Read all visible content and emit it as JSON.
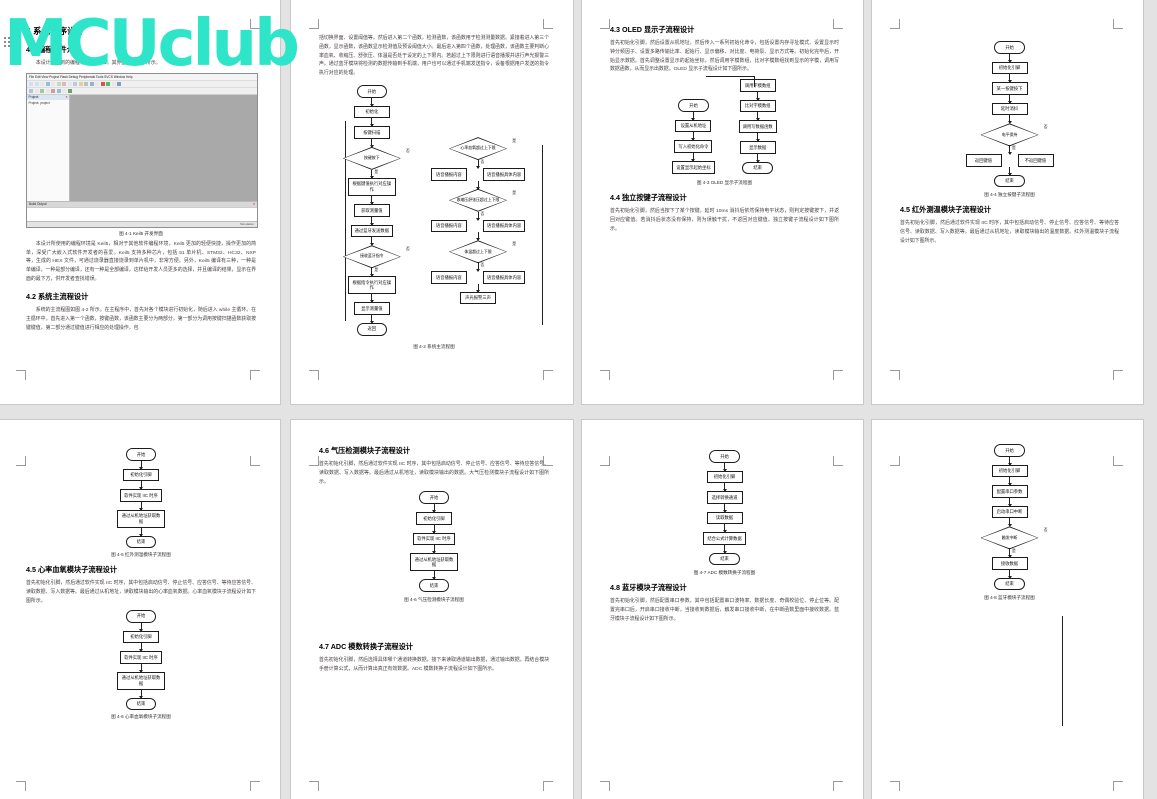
{
  "watermark": {
    "text": "MCUclub",
    "color": "#2ee5ca"
  },
  "page1": {
    "h1": "4 系统程序设计",
    "h2": "4.1 编程软件介绍",
    "intro": "本设计所用到的编程软件为 Keil5，其界面如图 4-1 所示。",
    "keil": {
      "menu": "File Edit View Project Flash Debug Peripherals Tools SVCS Window Help",
      "panel_title": "Project",
      "tree_item": "Project: project",
      "output_title": "Build Output",
      "status": "Simulation"
    },
    "caption": "图 4-1 Keil5 开发界面",
    "para": "本设计所使用的编程环境是 Keil5，相对于其他软件编程环境，Keil5 更加的轻便快捷，操作更加的简单，深受广大嵌入式软件开发者的喜爱。Keil5 支持多种芯片，包括 51 单片机、STM32、HC32、NXP 等，生成的 HEX 文件，可通过烧录器直接烧录到单片机中，非常方便。另外，Keil5 编译有三种，一种是单编译，一种是部分编译，还有一种是全部编译，这样给开发人员更多的选择，并且编译的结果，显示在界面的最下方，供开发者查找错误。",
    "h3": "4.2 系统主流程设计",
    "para2": "系统的主流程图如图 4-2 所示。在主程序中，首先对各个模块进行初始化，随后进入 while 主循环。在主循环中，首先进入第一个函数，按键函数，该函数主要分为两部分，第一部分为调用按键扫描函数获取按键键值，第二部分通过键值进行相应的处理操作，包"
  },
  "page2": {
    "para": "括切换界面、设置阈值等。然后进入第二个函数，检测函数，该函数用于检测测量数据。紧接着进入第三个函数，显示函数，该函数显示检测值及预设阈值大小。最后进入第四个函数，处理函数，该函数主要判断心率血氧、收缩压、舒张压、体温是否处于设定的上下限内。若超过上下限则进行语音播报并进行声光报警三声。通过蓝牙模块将检测的数据传输到手机端，用户也可以通过手机端发送指令，设备根据用户发送的指令执行对应的处理。",
    "caption": "图 4-2 系统主流程图",
    "fcL": [
      {
        "k": "t",
        "t": "开始"
      },
      {
        "k": "b",
        "t": "初始化"
      },
      {
        "k": "b",
        "t": "按键扫描"
      },
      {
        "k": "d",
        "t": "按键按下",
        "rl": "否"
      },
      {
        "k": "b",
        "t": "根据键值执行对应操作",
        "al": "是"
      },
      {
        "k": "b",
        "t": "获取测量值"
      },
      {
        "k": "b",
        "t": "通过蓝牙发送数据"
      },
      {
        "k": "d",
        "t": "接收蓝牙指令",
        "rl": "否"
      },
      {
        "k": "b",
        "t": "根据指令执行对应操作",
        "al": "是"
      },
      {
        "k": "b",
        "t": "显示测量值"
      },
      {
        "k": "t",
        "t": "返回"
      }
    ],
    "fcR": [
      {
        "k": "d",
        "t": "心率血氧超过上下限",
        "rl": "是"
      },
      {
        "k": "row",
        "al": "否",
        "items": [
          {
            "t": "语音播报内容"
          },
          {
            "t": "语音播报具体内容"
          }
        ]
      },
      {
        "k": "d",
        "t": "收缩压舒张压超过上下限",
        "rl": "是"
      },
      {
        "k": "row",
        "al": "否",
        "items": [
          {
            "t": "语音播报内容"
          },
          {
            "t": "语音播报具体内容"
          }
        ]
      },
      {
        "k": "d",
        "t": "体温超过上下限",
        "rl": "是"
      },
      {
        "k": "row",
        "al": "否",
        "items": [
          {
            "t": "语音播报内容"
          },
          {
            "t": "语音播报具体内容"
          }
        ]
      },
      {
        "k": "b",
        "t": "声光报警三声"
      }
    ]
  },
  "page3": {
    "h1": "4.3 OLED 显示子流程设计",
    "para": "首先初始化引脚，然后设置从机地址，然后传入一系列初始化命令，包括设置内存寻址模式、设置显示时钟分频因子、设置多路传输比率、起始行、显示偏移、对比度、电荷泵、显示方式等。初始化完毕后，开始显示数据。首先调整设置显示的起始坐标，然后调用字模数组，比对字模数组找到显示的字模，调用写数据函数，从而显示出数据。OLED 显示子流程设计如下图所示。",
    "fcL": [
      {
        "k": "t",
        "t": "开始"
      },
      {
        "k": "b",
        "t": "设置从机地址"
      },
      {
        "k": "b",
        "t": "写入初始化命令"
      },
      {
        "k": "b",
        "t": "设置显示起始坐标"
      }
    ],
    "fcR": [
      {
        "k": "b",
        "t": "调用字模数组"
      },
      {
        "k": "b",
        "t": "比对字模数组"
      },
      {
        "k": "b",
        "t": "调用写数据函数"
      },
      {
        "k": "b",
        "t": "显示数据"
      },
      {
        "k": "t",
        "t": "结束"
      }
    ],
    "caption": "图 4-3 OLED 显示子流程图",
    "h2": "4.4 独立按键子流程设计",
    "para2": "首先初始化引脚，然后当按下了某个按键，延时 10ms 消抖后依然保持电平状态，则判定按键按下，并返回对应键值。若消抖后状态没有保持，则为误触干扰，不返回对应键值。独立按键子流程设计如下图所示。"
  },
  "page4": {
    "fc": [
      {
        "k": "t",
        "t": "开始"
      },
      {
        "k": "b",
        "t": "初始化引脚"
      },
      {
        "k": "b",
        "t": "某一按键按下"
      },
      {
        "k": "b",
        "t": "延时消抖"
      },
      {
        "k": "d",
        "t": "电平保持",
        "rl": "否"
      },
      {
        "k": "row",
        "al": "是",
        "items": [
          {
            "t": "返回键值"
          },
          {
            "t": "不返回键值"
          }
        ]
      },
      {
        "k": "t",
        "t": "结束"
      }
    ],
    "caption": "图 4-4 独立按键子流程图",
    "h1": "4.5 红外测温模块子流程设计",
    "para": "首先初始化引脚，然后通过软件实现 IIC 时序，其中包括启动信号、停止信号、应答信号、等待应答信号、读取数据、写入数据等。最后通过从机地址，读取模块输出的温度数据。红外测温模块子流程设计如下图所示。"
  },
  "page5": {
    "fc1": [
      {
        "k": "t",
        "t": "开始"
      },
      {
        "k": "b",
        "t": "初始化引脚"
      },
      {
        "k": "b",
        "t": "软件实现 IIC 时序"
      },
      {
        "k": "b",
        "t": "通过从机地址获取数据"
      },
      {
        "k": "t",
        "t": "结束"
      }
    ],
    "caption1": "图 4-5 红外测温模块子流程图",
    "h1": "4.5 心率血氧模块子流程设计",
    "para": "首先初始化引脚，然后通过软件实现 IIC 时序，其中包括启动信号、停止信号、应答信号、等待应答信号、读取数据、写入数据等。最后通过从机地址，读取模块输出的心率血氧数据。心率血氧模块子流程设计如下图所示。",
    "fc2": [
      {
        "k": "t",
        "t": "开始"
      },
      {
        "k": "b",
        "t": "初始化引脚"
      },
      {
        "k": "b",
        "t": "软件实现 IIC 时序"
      },
      {
        "k": "b",
        "t": "通过从机地址获取数据"
      },
      {
        "k": "t",
        "t": "结束"
      }
    ],
    "caption2": "图 4-6 心率血氧模块子流程图"
  },
  "page6": {
    "h1": "4.6 气压检测模块子流程设计",
    "para": "首先初始化引脚，然后通过软件实现 IIC 时序，其中包括启动信号、停止信号、应答信号、等待应答信号、读取数据、写入数据等。最后通过从机地址，读取模块输出的数据。大气压检测模块子流程设计如下图所示。",
    "fc": [
      {
        "k": "t",
        "t": "开始"
      },
      {
        "k": "b",
        "t": "初始化引脚"
      },
      {
        "k": "b",
        "t": "软件实现 IIC 时序"
      },
      {
        "k": "b",
        "t": "通过从机地址获取数据"
      },
      {
        "k": "t",
        "t": "结束"
      }
    ],
    "caption": "图 4-6 气压检测模块子流程图",
    "h2": "4.7 ADC 模数转换子流程设计",
    "para2": "首先初始化引脚，然后选择具体哪个通道转换数据，接下来读取通道输出数据，通过输出数据，再结合模块手册计算公式，从而计算出真正有效数据。ADC 模数转换子流程设计如下图所示。"
  },
  "page7": {
    "fc": [
      {
        "k": "t",
        "t": "开始"
      },
      {
        "k": "b",
        "t": "初始化引脚"
      },
      {
        "k": "b",
        "t": "选择转换通道"
      },
      {
        "k": "b",
        "t": "读取数据"
      },
      {
        "k": "b",
        "t": "结合公式计算数据"
      },
      {
        "k": "t",
        "t": "结束"
      }
    ],
    "caption": "图 4-7 ADC 模数转换子流程图",
    "h1": "4.8 蓝牙模块子流程设计",
    "para": "首先初始化引脚，然后配置串口参数，其中包括配置串口波特率、数据长度、奇偶校验位、停止位等。配置完串口后，开启串口接收中断，当接收到数据后，触发串口接收中断，在中断函数里面中接收数据。蓝牙模块子流程设计如下图所示。"
  },
  "page8": {
    "fc": [
      {
        "k": "t",
        "t": "开始"
      },
      {
        "k": "b",
        "t": "初始化引脚"
      },
      {
        "k": "b",
        "t": "配置串口参数"
      },
      {
        "k": "b",
        "t": "启动串口中断"
      },
      {
        "k": "d",
        "t": "触发中断",
        "rl": "否"
      },
      {
        "k": "b",
        "t": "接收数据",
        "al": "是"
      },
      {
        "k": "t",
        "t": "结束"
      }
    ],
    "caption": "图 4-8 蓝牙模块子流程图"
  }
}
